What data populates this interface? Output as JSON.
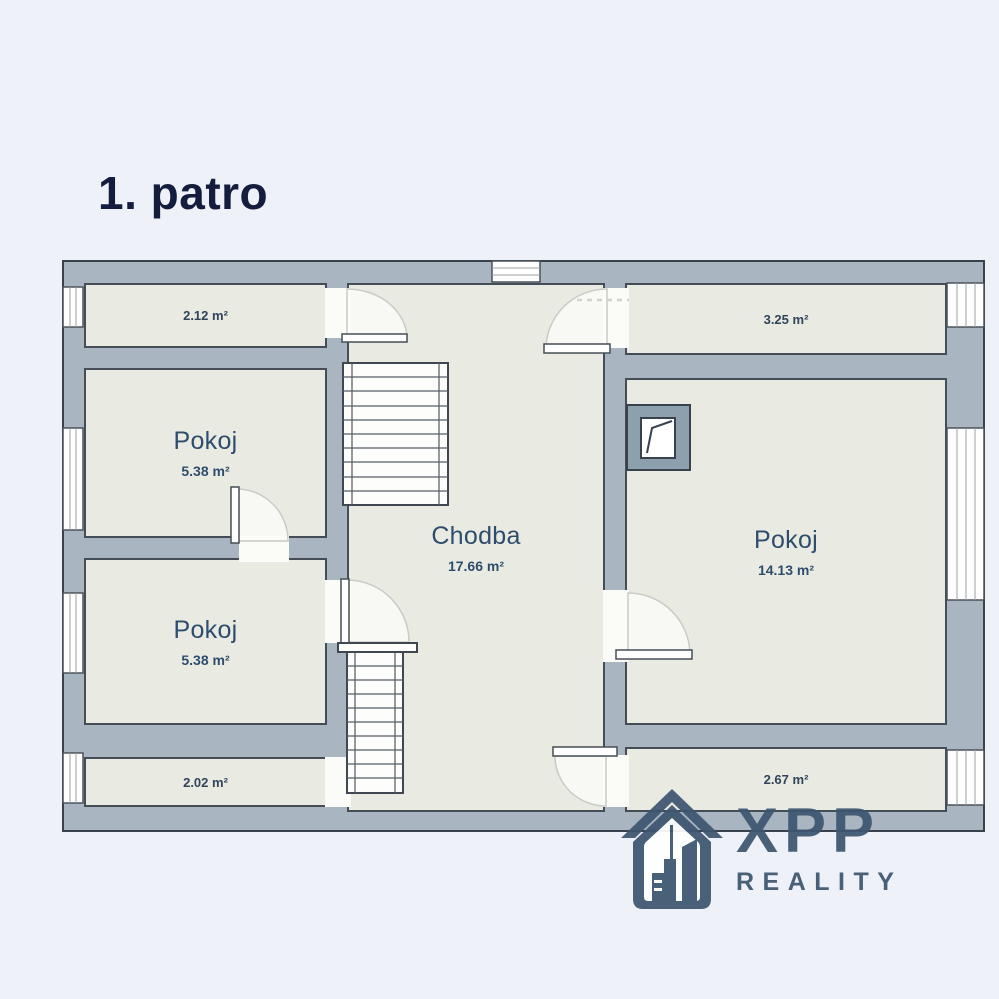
{
  "title": "1. patro",
  "plan": {
    "rooms": {
      "storage_top_left": {
        "name": "",
        "area": "2.12 m²"
      },
      "pokoj_upper_left": {
        "name": "Pokoj",
        "area": "5.38 m²"
      },
      "pokoj_lower_left": {
        "name": "Pokoj",
        "area": "5.38 m²"
      },
      "storage_bottom_left": {
        "name": "",
        "area": "2.02 m²"
      },
      "chodba": {
        "name": "Chodba",
        "area": "17.66 m²"
      },
      "storage_top_right": {
        "name": "",
        "area": "3.25 m²"
      },
      "pokoj_right": {
        "name": "Pokoj",
        "area": "14.13 m²"
      },
      "storage_bottom_right": {
        "name": "",
        "area": "2.67 m²"
      }
    },
    "colors": {
      "wall_fill": "#a9b6c1",
      "floor_fill": "#e9ebe3",
      "outline": "#39424c",
      "room_label": "#2e4d6d",
      "background": "#eef1f7"
    }
  },
  "logo": {
    "name": "XPP",
    "subtitle": "REALITY",
    "color": "#3d5670",
    "icon": "house-city-icon"
  }
}
